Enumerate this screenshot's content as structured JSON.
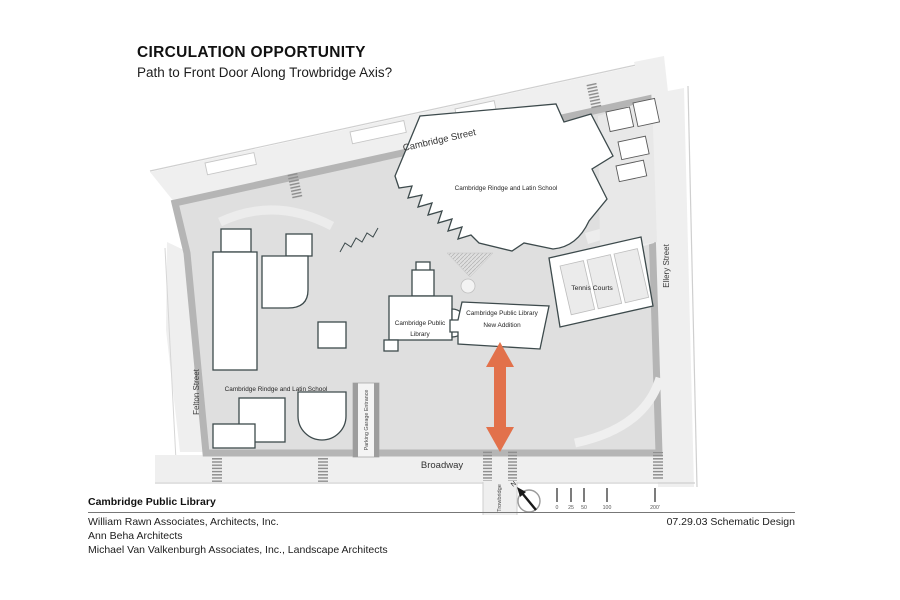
{
  "title": {
    "heading": "CIRCULATION OPPORTUNITY",
    "subheading": "Path to Front Door Along Trowbridge Axis?"
  },
  "plan": {
    "streets": {
      "cambridge": "Cambridge Street",
      "broadway": "Broadway",
      "ellery": "Ellery Street",
      "felton": "Felton Street",
      "trowbridge": "Trowbridge"
    },
    "buildings": {
      "school_north": "Cambridge Rindge and Latin School",
      "school_west": "Cambridge Rindge and Latin School",
      "library_line1": "Cambridge Public",
      "library_line2": "Library",
      "addition_line1": "Cambridge Public Library",
      "addition_line2": "New Addition",
      "tennis": "Tennis Courts",
      "garage": "Parking Garage Entrance"
    },
    "compass_label": "N",
    "scale_ticks": [
      "0",
      "25",
      "50",
      "100",
      "200'"
    ],
    "colors": {
      "arrow": "#e2714b",
      "site_fill": "#dfdfdf",
      "street_fill": "#efefef",
      "curb": "#b5b5b5",
      "building_outline": "#3d4a4c"
    }
  },
  "footer": {
    "project": "Cambridge Public Library",
    "firm_lines": [
      "William Rawn Associates, Architects, Inc.",
      "Ann Beha Architects",
      "Michael Van Valkenburgh Associates, Inc., Landscape Architects"
    ],
    "date_phase": "07.29.03 Schematic Design"
  }
}
